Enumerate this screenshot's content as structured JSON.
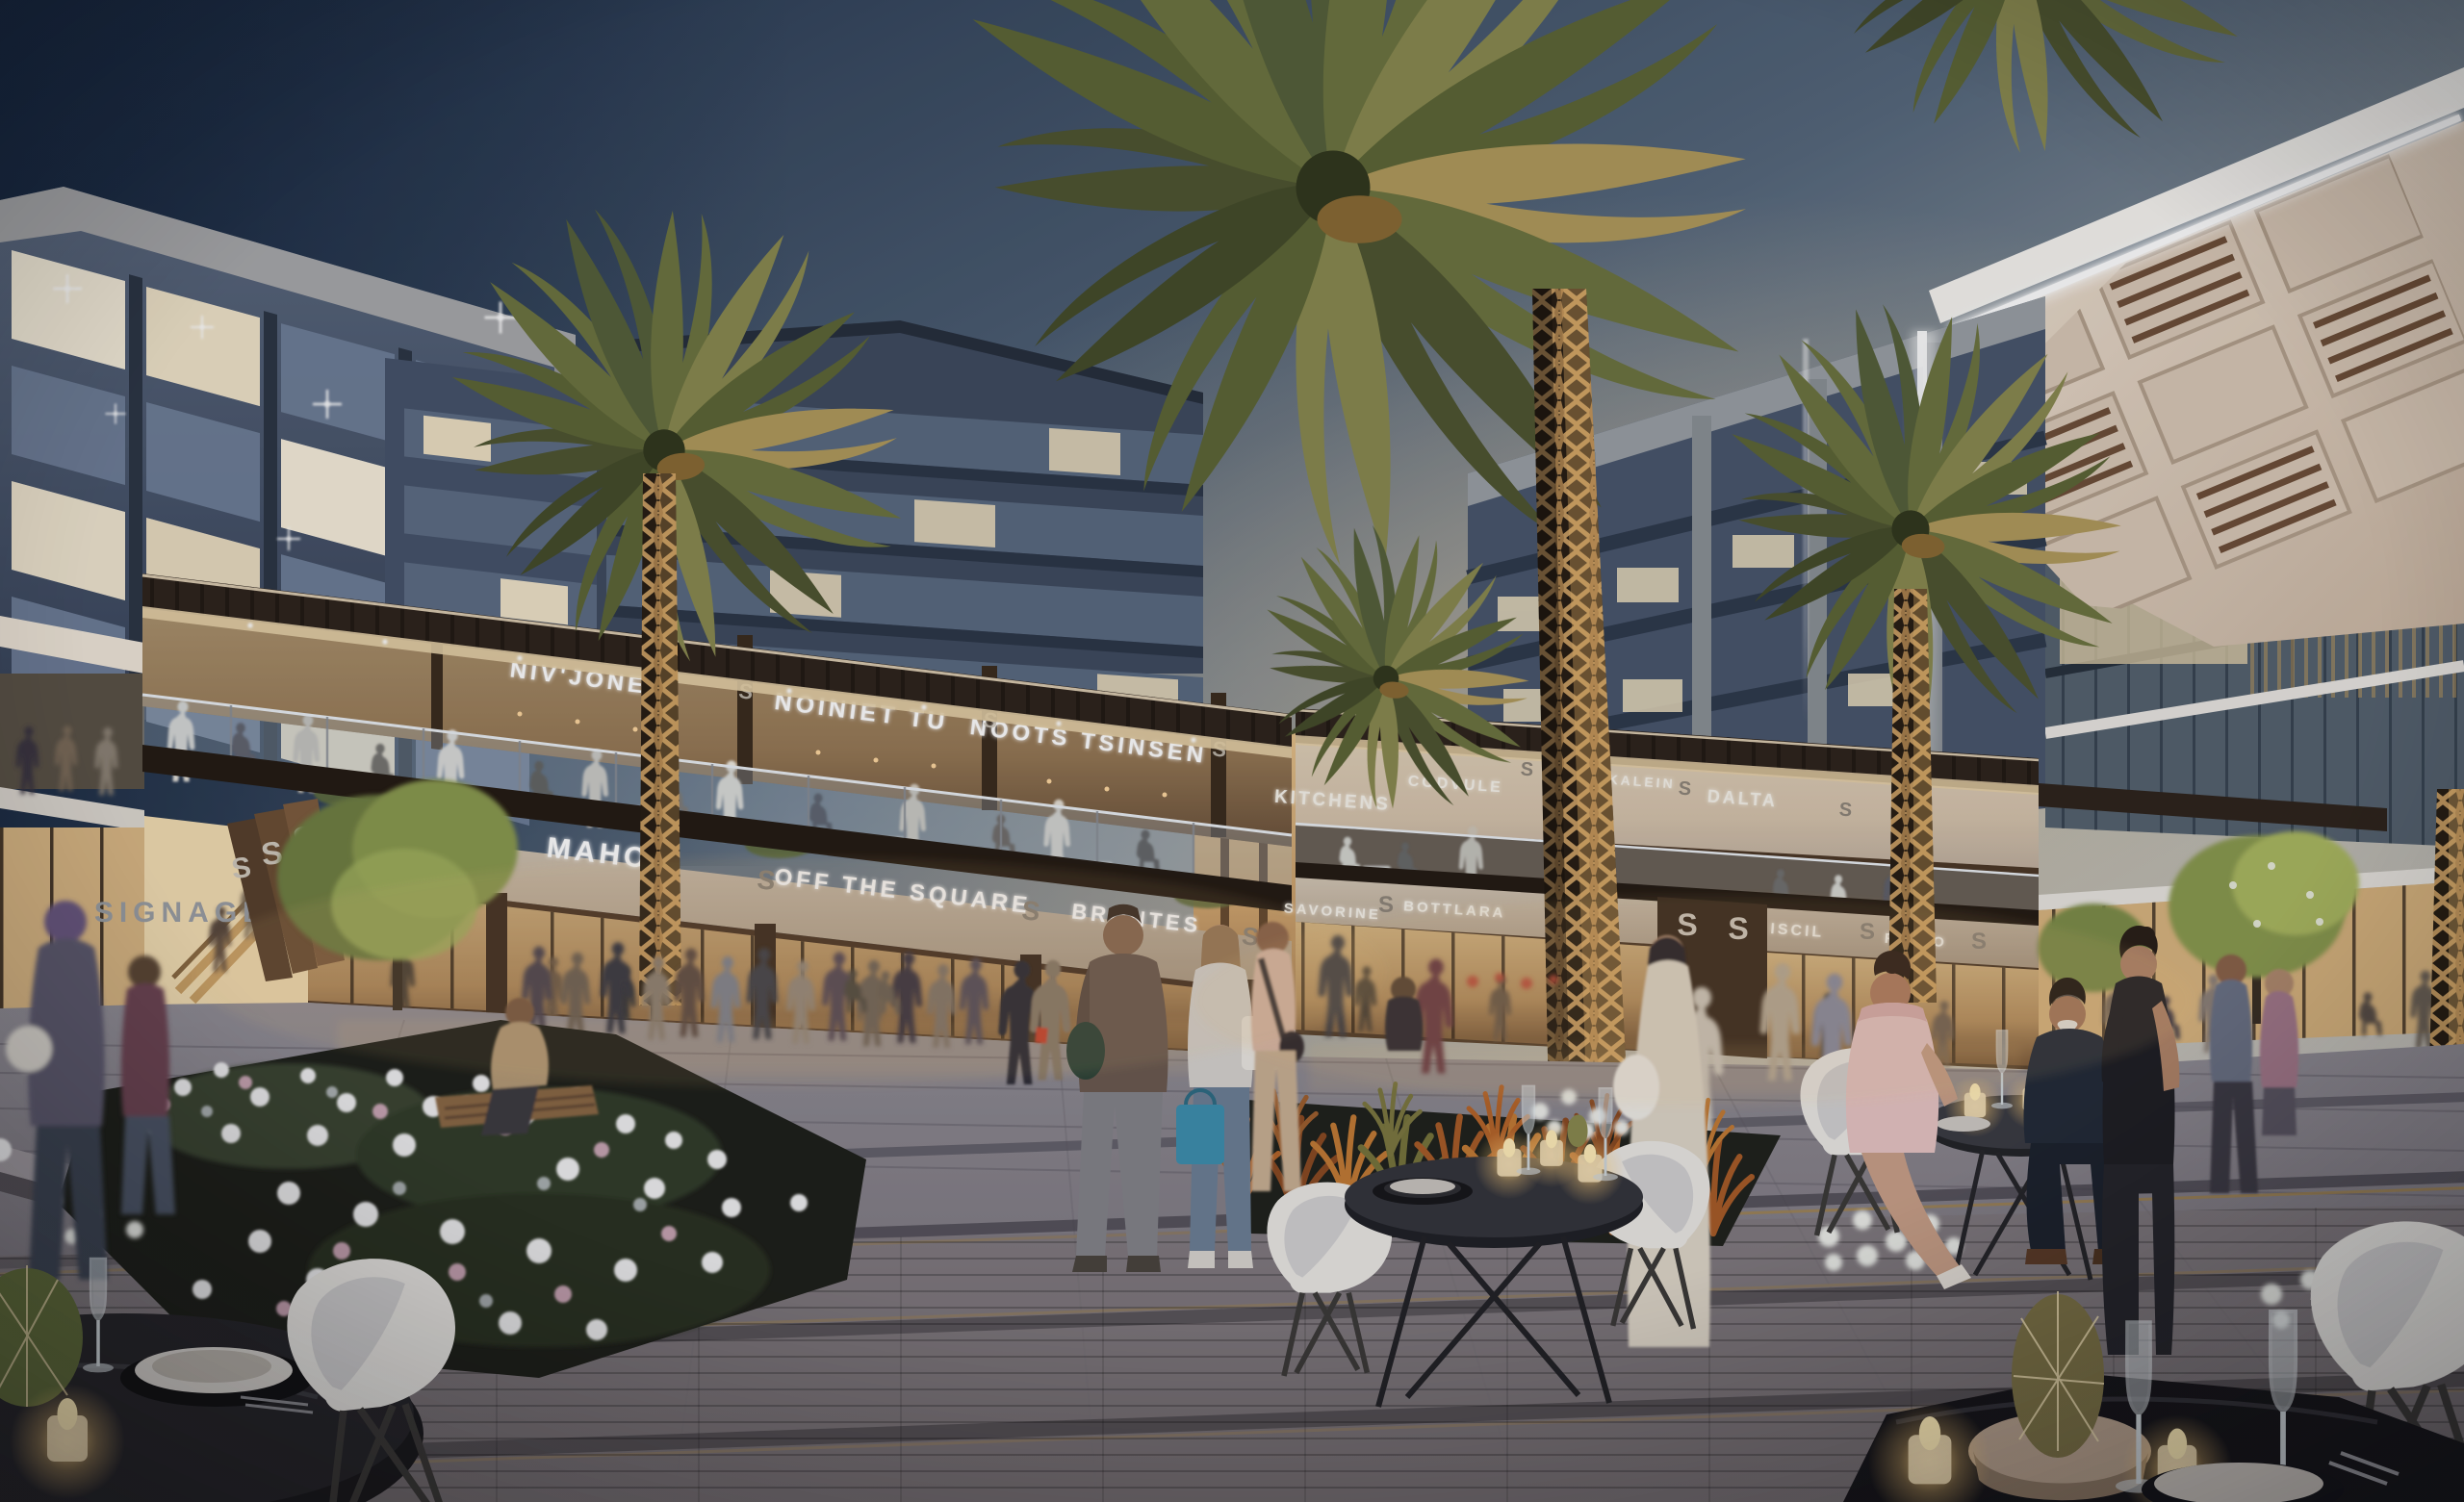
{
  "scene": {
    "description": "Dusk architectural rendering of a mixed-use retail plaza with palm trees, terrace restaurants, glowing canopy and outdoor dining",
    "signs": {
      "niv_jone": "NIV'JONE",
      "noiniet_tu": "NOINIET TU",
      "noots_tsinsen": "NOOTS TSINSEN",
      "mahom": "MAHOM",
      "off_the_square": "OFF THE SQUARE",
      "brontes": "BRONTES",
      "kitchens": "KITCHENS",
      "codvule": "CODVULE",
      "tsikalein": "TSIKALEIN",
      "dalta": "DALTA",
      "savorine": "SAVORINE",
      "bottlara": "BOTTLARA",
      "iscil": "ISCIL",
      "rooio": "ROOIO",
      "signage_wall": "SIGNAGE",
      "monogram": "S"
    },
    "palette": {
      "sky_top": "#1f3049",
      "sky_mid": "#56687c",
      "sky_light": "#a9aeae",
      "sky_horizon": "#dad2c5",
      "led_white": "#ffffff",
      "wood_bronze": "#42301f",
      "interior_glow": "#f2d6a6",
      "sign_band": "#c6b7a4",
      "paving": "#87848d",
      "flower_white": "#efeff0",
      "grass_orange": "#bf7633",
      "palm_green": "#5c6136",
      "trunk_gold": "#c49a60",
      "candle_glow": "#ffd98f"
    }
  }
}
